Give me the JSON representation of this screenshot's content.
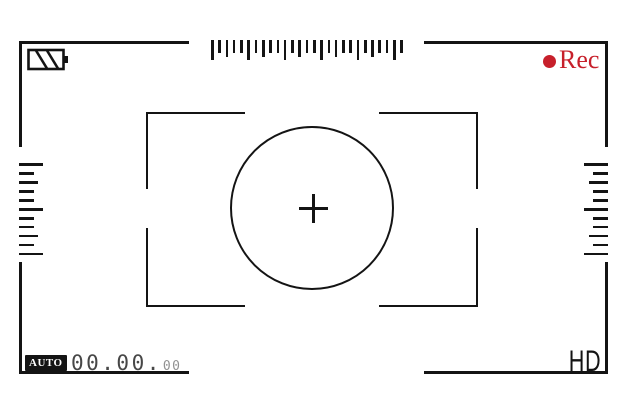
{
  "frame": {
    "line_color": "#141414",
    "background": "#ffffff"
  },
  "status_bar": {
    "battery": {
      "icon": "battery-diagonal-stripes-icon",
      "level_style": "striped"
    },
    "rec": {
      "label": "Rec",
      "color": "#c7202b",
      "dot_icon": "record-dot-icon"
    }
  },
  "rulers": {
    "top": {
      "orientation": "horizontal",
      "tick_count": 27,
      "tick_heights": [
        20,
        13,
        17,
        13,
        13,
        20,
        13,
        17,
        13,
        13,
        20,
        13,
        17,
        13,
        13,
        20,
        13,
        17,
        13,
        13,
        20,
        13,
        17,
        13,
        13,
        20,
        13
      ]
    },
    "left": {
      "orientation": "vertical",
      "tick_count": 11,
      "tick_lengths": [
        24,
        15,
        19,
        15,
        15,
        24,
        15,
        15,
        19,
        15,
        24
      ]
    },
    "right": {
      "orientation": "vertical",
      "tick_count": 11,
      "tick_lengths": [
        24,
        15,
        19,
        15,
        15,
        24,
        15,
        15,
        19,
        15,
        24
      ]
    }
  },
  "focus_area": {
    "crosshair_icon": "crosshair-plus-icon",
    "circle_icon": "focus-circle"
  },
  "bottom_bar": {
    "mode_badge": "AUTO",
    "counter": {
      "main": "00.00.",
      "frames": "00"
    },
    "quality_label": "HD"
  }
}
